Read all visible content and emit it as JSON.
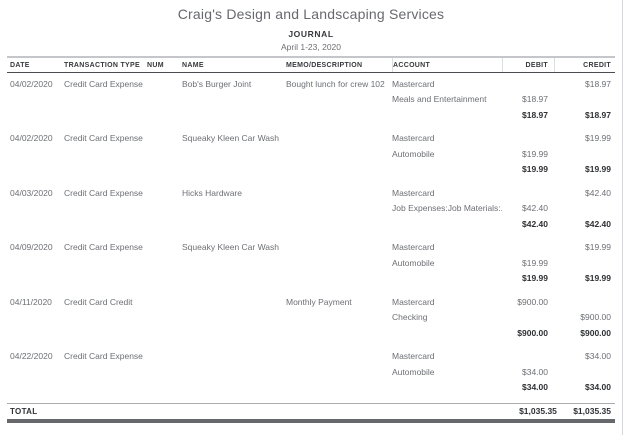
{
  "report": {
    "company": "Craig's Design and Landscaping Services",
    "title": "JOURNAL",
    "date_range": "April 1-23, 2020"
  },
  "columns": {
    "date": "DATE",
    "type": "TRANSACTION TYPE",
    "num": "NUM",
    "name": "NAME",
    "memo": "MEMO/DESCRIPTION",
    "account": "ACCOUNT",
    "debit": "DEBIT",
    "credit": "CREDIT"
  },
  "rows": [
    {
      "date": "04/02/2020",
      "type": "Credit Card Expense",
      "num": "",
      "name": "Bob's Burger Joint",
      "memo": "Bought lunch for crew 102",
      "account": "Mastercard",
      "debit": "",
      "credit": "$18.97"
    },
    {
      "account": "Meals and Entertainment",
      "debit": "$18.97",
      "credit": ""
    },
    {
      "debit": "$18.97",
      "credit": "$18.97"
    },
    {
      "date": "04/02/2020",
      "type": "Credit Card Expense",
      "num": "",
      "name": "Squeaky Kleen Car Wash",
      "memo": "",
      "account": "Mastercard",
      "debit": "",
      "credit": "$19.99"
    },
    {
      "account": "Automobile",
      "debit": "$19.99",
      "credit": ""
    },
    {
      "debit": "$19.99",
      "credit": "$19.99"
    },
    {
      "date": "04/03/2020",
      "type": "Credit Card Expense",
      "num": "",
      "name": "Hicks Hardware",
      "memo": "",
      "account": "Mastercard",
      "debit": "",
      "credit": "$42.40"
    },
    {
      "account": "Job Expenses:Job Materials:...",
      "debit": "$42.40",
      "credit": ""
    },
    {
      "debit": "$42.40",
      "credit": "$42.40"
    },
    {
      "date": "04/09/2020",
      "type": "Credit Card Expense",
      "num": "",
      "name": "Squeaky Kleen Car Wash",
      "memo": "",
      "account": "Mastercard",
      "debit": "",
      "credit": "$19.99"
    },
    {
      "account": "Automobile",
      "debit": "$19.99",
      "credit": ""
    },
    {
      "debit": "$19.99",
      "credit": "$19.99"
    },
    {
      "date": "04/11/2020",
      "type": "Credit Card Credit",
      "num": "",
      "name": "",
      "memo": "Monthly Payment",
      "account": "Mastercard",
      "debit": "$900.00",
      "credit": ""
    },
    {
      "account": "Checking",
      "debit": "",
      "credit": "$900.00"
    },
    {
      "debit": "$900.00",
      "credit": "$900.00"
    },
    {
      "date": "04/22/2020",
      "type": "Credit Card Expense",
      "num": "",
      "name": "",
      "memo": "",
      "account": "Mastercard",
      "debit": "",
      "credit": "$34.00"
    },
    {
      "account": "Automobile",
      "debit": "$34.00",
      "credit": ""
    },
    {
      "debit": "$34.00",
      "credit": "$34.00"
    }
  ],
  "total": {
    "label": "TOTAL",
    "debit": "$1,035.35",
    "credit": "$1,035.35"
  }
}
